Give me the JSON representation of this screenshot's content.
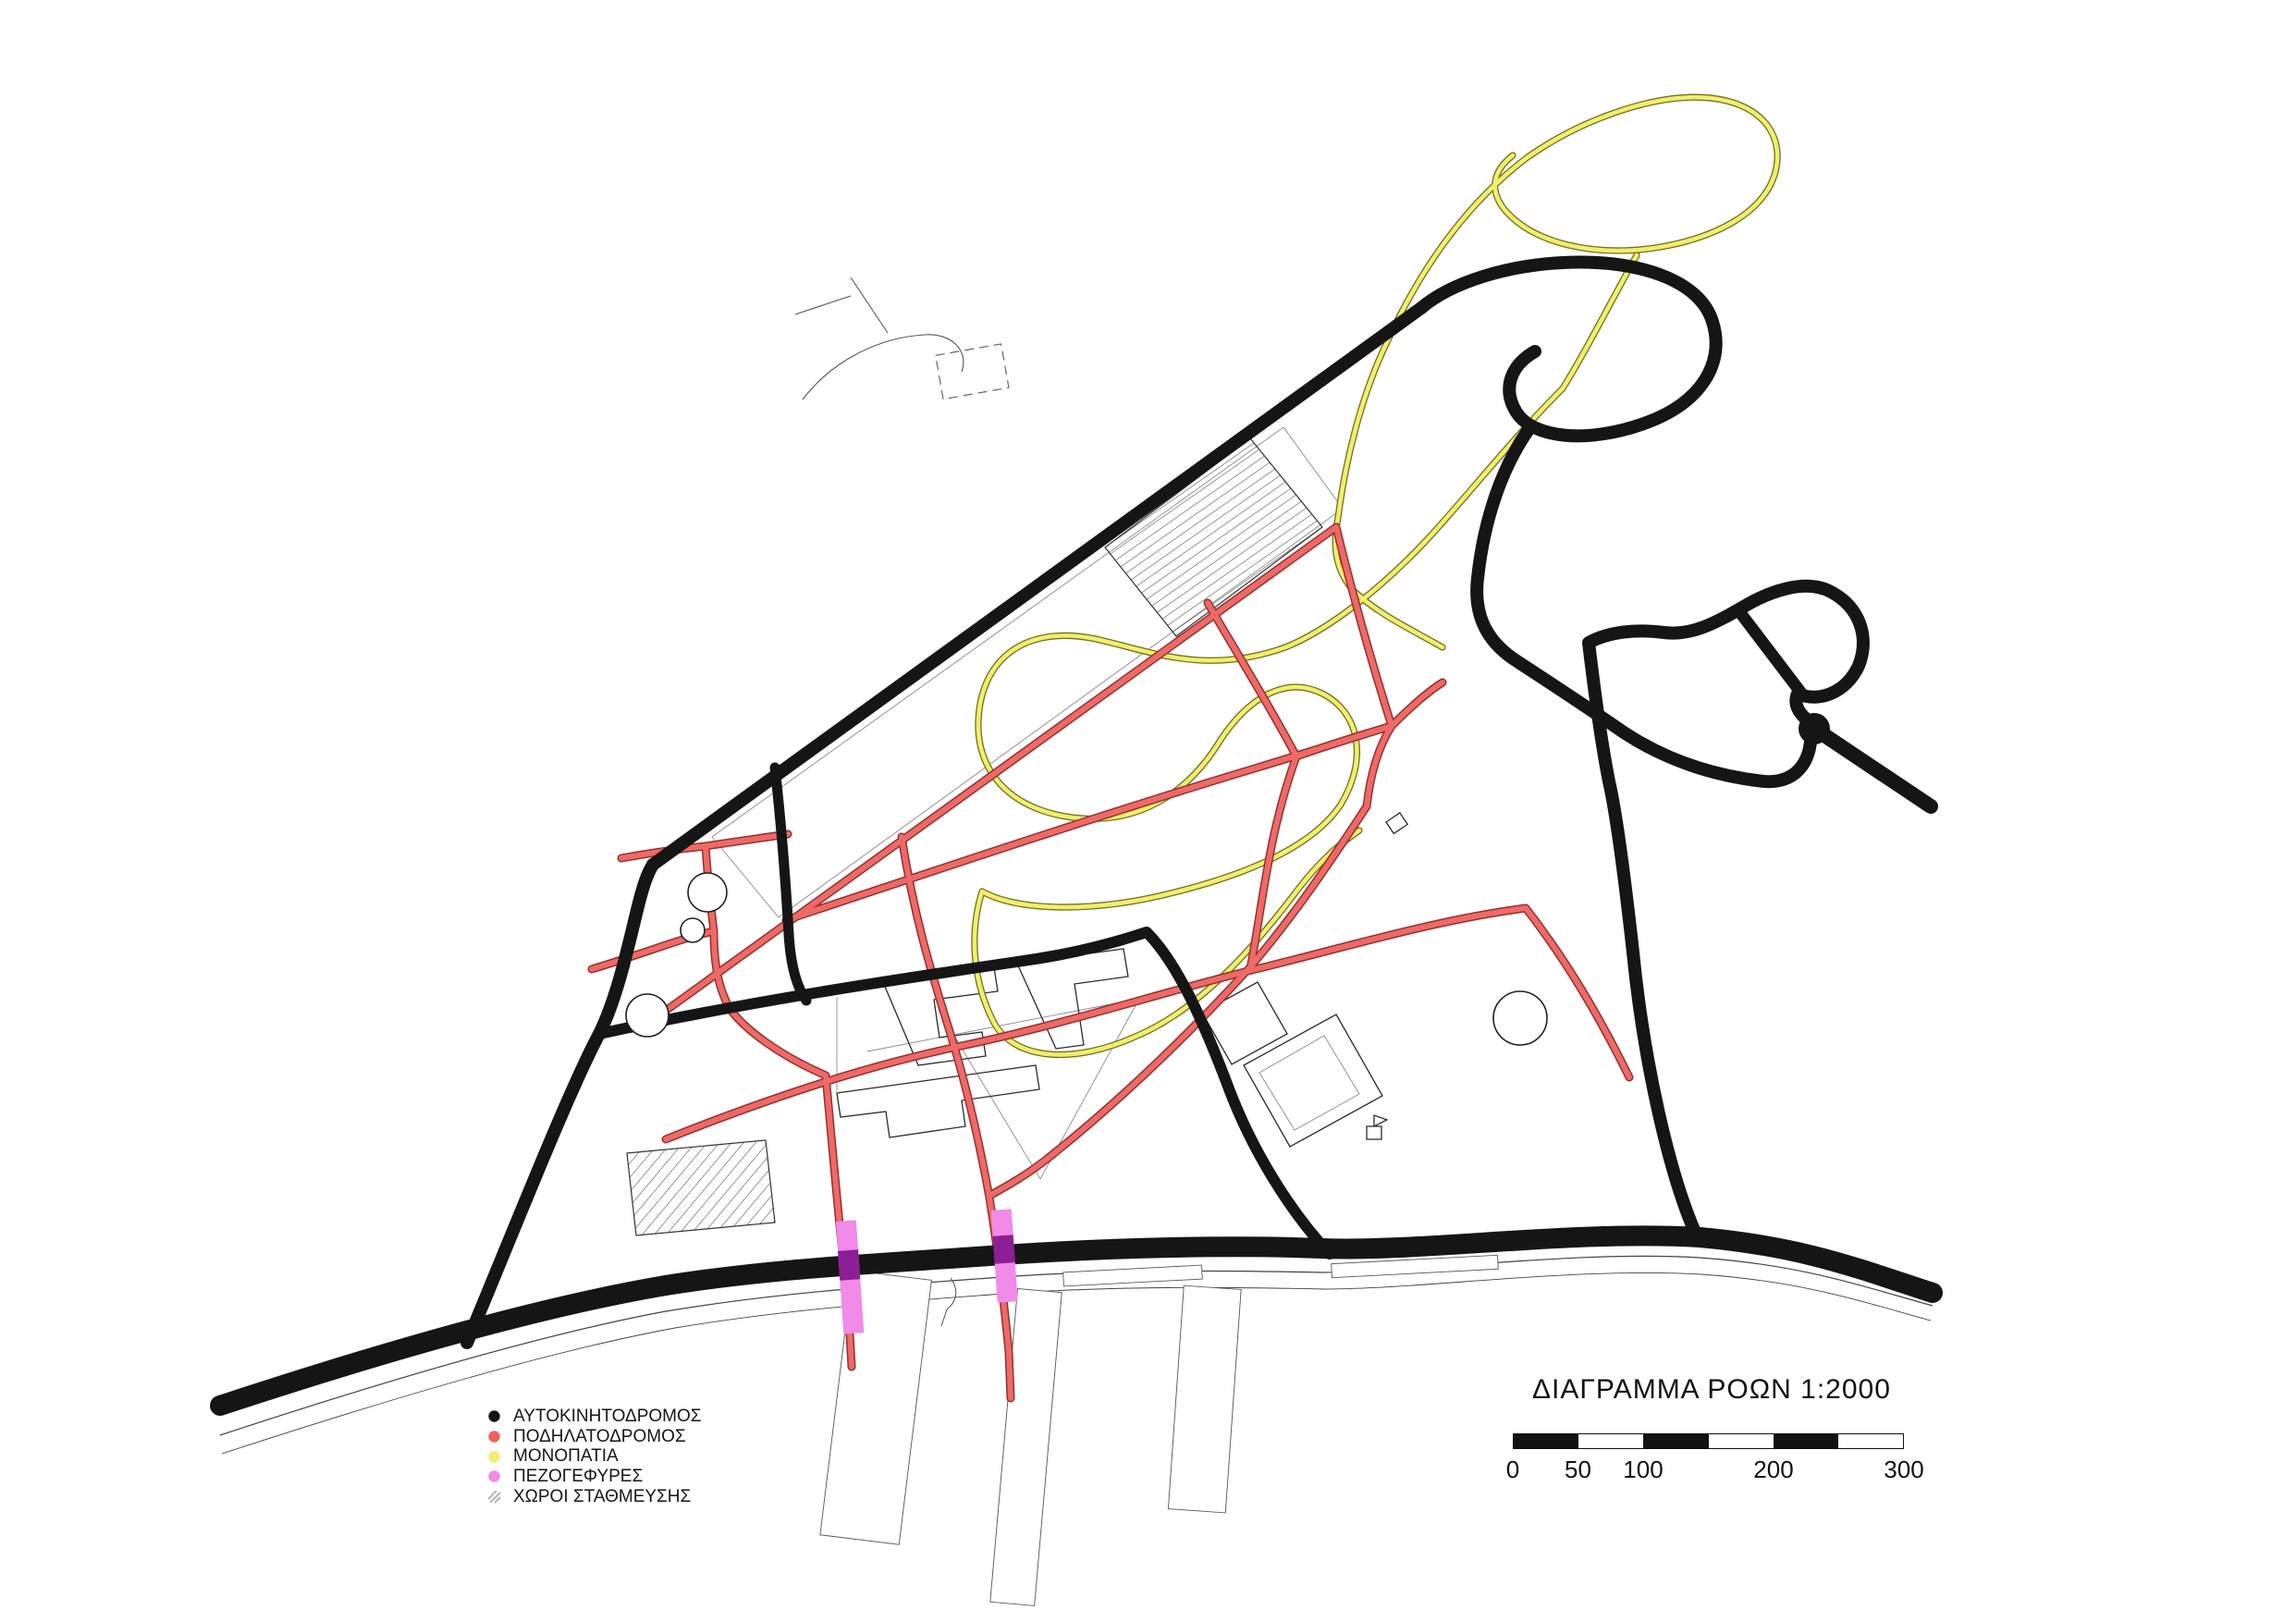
{
  "title": {
    "text": "ΔΙΑΓΡΑΜΜΑ ΡΟΩΝ 1:2000"
  },
  "legend": {
    "items": [
      {
        "id": "motorway",
        "label": "ΑΥΤΟΚΙΝΗΤΟΔΡΟΜΟΣ",
        "color": "#141414",
        "swatch": "dot"
      },
      {
        "id": "cycleway",
        "label": "ΠΟΔΗΛΑΤΟΔΡΟΜΟΣ",
        "color": "#ee6260",
        "swatch": "dot"
      },
      {
        "id": "footpaths",
        "label": "ΜΟΝΟΠΑΤΙΑ",
        "color": "#f2ee6e",
        "swatch": "dot"
      },
      {
        "id": "footbridges",
        "label": "ΠΕΖΟΓΕΦΥΡΕΣ",
        "color": "#f18ae9",
        "swatch": "dot"
      },
      {
        "id": "parking",
        "label": "ΧΩΡΟΙ ΣΤΑΘΜΕΥΣΗΣ",
        "color": "#aaaaaa",
        "swatch": "hatch"
      }
    ]
  },
  "scalebar": {
    "labels": [
      "0",
      "50",
      "100",
      "200",
      "300"
    ]
  },
  "map": {
    "colors": {
      "motorway": "#151515",
      "cycleway": "#ee6a66",
      "footpath": "#f2ee6e",
      "footbridge_light": "#f08ae9",
      "footbridge_on_road": "#8c1f96",
      "contour": "#c9c9c9"
    }
  }
}
